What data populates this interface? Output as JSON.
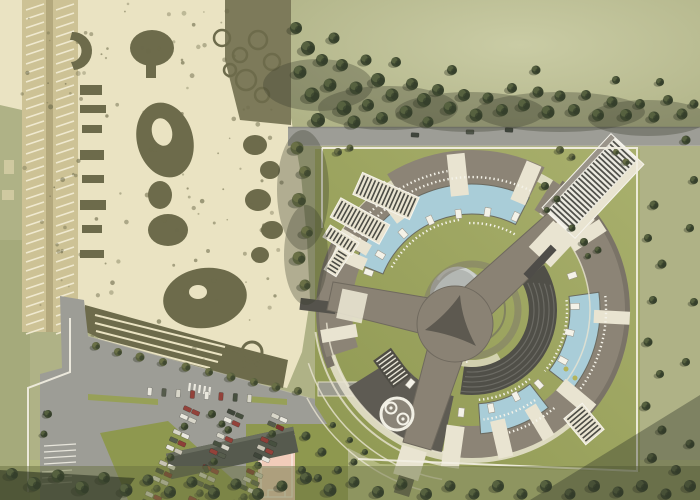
{
  "meta": {
    "view": "aerial-site-plan"
  },
  "palette": {
    "field": "#afb286",
    "fieldLight": "#c7c9a2",
    "fieldBottom": "#b4ba7e",
    "lawn": "#9ea762",
    "lawnDark": "#8e984f",
    "photoBg": "#eae3c2",
    "photoDark": "#6d6b4b",
    "photoDark2": "#7c7a57",
    "photoMid": "#a89f76",
    "photoRoad": "#cdc295",
    "road": "#9d9d96",
    "roadDark": "#8b8b84",
    "bldg": "#8c8476",
    "bldgDark": "#7a7367",
    "wing": "#5e5b53",
    "pool": "#a9cdd8",
    "cream": "#e9e4d1",
    "white": "#f4f2e8",
    "ybldg": "#8a8274",
    "innerDark": "#504f48",
    "treeDark": "#3e4830",
    "treeLight": "#5c6844",
    "treeOlive": "#59603e",
    "court": "#f1ccba",
    "carRed": "#8e3f38",
    "shadow": "rgba(52,57,40,0.38)"
  },
  "scene": {
    "complex": {
      "center": [
        472,
        310
      ],
      "arcs": [
        {
          "n": "outer-walk-1",
          "r1": 144,
          "r2": 153,
          "a0": -180,
          "a1": 0,
          "f": "cream",
          "o": 0.85
        },
        {
          "n": "outer-walk-2",
          "r1": 144,
          "r2": 153,
          "a0": 0,
          "a1": 180,
          "f": "cream",
          "o": 0.85
        },
        {
          "n": "topleft-bldg",
          "r1": 122,
          "r2": 152,
          "a0": -153,
          "a1": -126,
          "f": "bldg"
        },
        {
          "n": "top-roof",
          "r1": 114,
          "r2": 160,
          "a0": -122,
          "a1": -63,
          "f": "bldg"
        },
        {
          "n": "left-outer",
          "r1": 148,
          "r2": 156,
          "a0": 158,
          "a1": 210,
          "f": "bldgDark"
        },
        {
          "n": "left-bldg",
          "r1": 120,
          "r2": 153,
          "a0": 162,
          "a1": 205,
          "f": "bldg"
        },
        {
          "n": "right-outer",
          "r1": 150,
          "r2": 158,
          "a0": -55,
          "a1": 42,
          "f": "bldgDark"
        },
        {
          "n": "right-bldg",
          "r1": 118,
          "r2": 153,
          "a0": -58,
          "a1": 40,
          "f": "bldg"
        },
        {
          "n": "bottomright-bldg",
          "r1": 116,
          "r2": 148,
          "a0": 42,
          "a1": 96,
          "f": "bldg"
        },
        {
          "n": "bottomleft-wing",
          "r1": 88,
          "r2": 146,
          "a0": 102,
          "a1": 148,
          "f": "wing"
        },
        {
          "n": "pool-upperleft",
          "r1": 96,
          "r2": 126,
          "a0": -158,
          "a1": -63,
          "f": "pool",
          "s": "#6a6a60"
        },
        {
          "n": "pool-right",
          "r1": 98,
          "r2": 128,
          "a0": -8,
          "a1": 38,
          "f": "pool",
          "s": "#6a6a60"
        },
        {
          "n": "pool-bottom",
          "r1": 94,
          "r2": 124,
          "a0": 52,
          "a1": 86,
          "f": "pool",
          "s": "#6a6a60"
        },
        {
          "n": "amphitheater",
          "r1": 57,
          "r2": 85,
          "a0": -32,
          "a1": 98,
          "f": "innerDark"
        },
        {
          "n": "inner-walk",
          "r1": 50,
          "r2": 57,
          "a0": 60,
          "a1": 150,
          "f": "cream",
          "o": 0.7
        }
      ],
      "gaps": [
        [
          -150,
          136,
          34,
          12
        ],
        [
          -127,
          135,
          42,
          16
        ],
        [
          -96,
          136,
          42,
          18
        ],
        [
          -67,
          138,
          42,
          16
        ],
        [
          -33,
          137,
          38,
          14
        ],
        [
          3,
          140,
          36,
          13
        ],
        [
          40,
          136,
          40,
          15
        ],
        [
          59,
          131,
          36,
          13
        ],
        [
          77,
          132,
          38,
          15
        ],
        [
          98,
          138,
          42,
          18
        ],
        [
          170,
          135,
          36,
          13
        ],
        [
          203,
          133,
          34,
          13
        ]
      ],
      "kiosks": [
        [
          -160,
          110
        ],
        [
          -149,
          107
        ],
        [
          -132,
          103
        ],
        [
          -115,
          99
        ],
        [
          -98,
          97
        ],
        [
          -81,
          99
        ],
        [
          -65,
          103
        ],
        [
          -44,
          105
        ],
        [
          -19,
          106
        ],
        [
          -2,
          103
        ],
        [
          13,
          100
        ],
        [
          29,
          104
        ],
        [
          48,
          100
        ],
        [
          63,
          97
        ],
        [
          79,
          100
        ],
        [
          96,
          103
        ],
        [
          113,
          99
        ],
        [
          130,
          96
        ]
      ],
      "lounger_arcs": [
        [
          133,
          -155,
          -64
        ],
        [
          141,
          -150,
          -100
        ],
        [
          91,
          -152,
          -98
        ],
        [
          87,
          -92,
          -60
        ],
        [
          134,
          -6,
          36
        ],
        [
          95,
          -6,
          40
        ],
        [
          110,
          55,
          84
        ],
        [
          90,
          50,
          86
        ],
        [
          128,
          50,
          74
        ],
        [
          52,
          95,
          150
        ]
      ],
      "step_arcs": [
        [
          62,
          -26,
          95
        ],
        [
          67,
          -24,
          96
        ],
        [
          72,
          -22,
          97
        ],
        [
          77,
          -20,
          97
        ],
        [
          82,
          -18,
          98
        ]
      ],
      "path_arcs": [
        [
          158,
          96,
          172,
          2
        ],
        [
          172,
          100,
          162,
          1.5
        ],
        [
          187,
          104,
          152,
          1.5
        ],
        [
          146,
          98,
          175,
          1.6
        ],
        [
          118,
          -55,
          40,
          1.5
        ]
      ],
      "panels": [
        {
          "x": 386,
          "y": 196,
          "w": 62,
          "h": 24,
          "rot": 24,
          "style": "light"
        },
        {
          "x": 360,
          "y": 221,
          "w": 56,
          "h": 22,
          "rot": 29,
          "style": "light"
        },
        {
          "x": 341,
          "y": 240,
          "w": 34,
          "h": 14,
          "rot": 32,
          "style": "light"
        },
        {
          "x": 337,
          "y": 262,
          "w": 26,
          "h": 14,
          "rot": -58,
          "style": "light"
        },
        {
          "x": 392,
          "y": 368,
          "w": 34,
          "h": 22,
          "rot": 54,
          "style": "dark"
        },
        {
          "x": 584,
          "y": 424,
          "w": 34,
          "h": 24,
          "rot": 50,
          "style": "light"
        },
        {
          "x": 593,
          "y": 186,
          "w": 100,
          "h": 44,
          "rot": -47,
          "style": "building"
        }
      ],
      "palm_markers": [
        [
          566,
          369
        ],
        [
          575,
          378
        ]
      ]
    },
    "boundary": [
      [
        [
          322,
          148
        ],
        [
          637,
          148
        ],
        [
          637,
          471
        ],
        [
          358,
          459
        ]
      ],
      [
        [
          322,
          148
        ],
        [
          322,
          228
        ]
      ],
      [
        [
          70,
          318
        ],
        [
          70,
          372
        ],
        [
          28,
          388
        ],
        [
          28,
          492
        ]
      ]
    ],
    "parking": {
      "car_colors": [
        "#e9e7dd",
        "#93423a",
        "#47503f",
        "#d8d6c9",
        "#7e332e",
        "#e9e7dd",
        "#3f463a",
        "#c8c4b4",
        "#8e3f38",
        "#e9e7dd",
        "#565c4c",
        "#d8d6c9",
        "#93423a"
      ],
      "rows": [
        {
          "x": 150,
          "y": 504,
          "len": 102,
          "dir": -66,
          "n": 13,
          "double": true
        },
        {
          "x": 193,
          "y": 509,
          "len": 104,
          "dir": -66,
          "n": 13,
          "double": true
        },
        {
          "x": 237,
          "y": 513,
          "len": 104,
          "dir": -66,
          "n": 13,
          "double": true
        },
        {
          "x": 150,
          "y": 387,
          "len": 100,
          "dir": 4,
          "n": 8,
          "double": false
        }
      ],
      "road_cars": [
        [
          415,
          135,
          3,
          "#3f453c"
        ],
        [
          470,
          132,
          2,
          "#50564a"
        ],
        [
          509,
          130,
          4,
          "#3f453c"
        ],
        [
          206,
          469,
          70,
          "#454b3f"
        ],
        [
          213,
          489,
          70,
          "#3f453c"
        ],
        [
          47,
          414,
          20,
          "#50564a"
        ]
      ]
    },
    "band_shadows": [
      [
        318,
        85,
        55,
        26
      ],
      [
        388,
        108,
        70,
        22
      ],
      [
        470,
        112,
        75,
        20
      ],
      [
        560,
        112,
        85,
        20
      ],
      [
        648,
        118,
        60,
        18
      ],
      [
        303,
        190,
        26,
        60
      ],
      [
        306,
        255,
        22,
        50
      ]
    ],
    "trees": [
      [
        296,
        28,
        1.2,
        0
      ],
      [
        308,
        48,
        1.4,
        0
      ],
      [
        300,
        72,
        1.3,
        0
      ],
      [
        312,
        95,
        1.5,
        0
      ],
      [
        322,
        60,
        1.2,
        0
      ],
      [
        318,
        120,
        1.4,
        0
      ],
      [
        330,
        85,
        1.3,
        0
      ],
      [
        334,
        38,
        1.1,
        0
      ],
      [
        344,
        108,
        1.5,
        0
      ],
      [
        342,
        65,
        1.2,
        0
      ],
      [
        356,
        88,
        1.3,
        0
      ],
      [
        354,
        122,
        1.3,
        0
      ],
      [
        366,
        60,
        1.1,
        0
      ],
      [
        368,
        105,
        1.2,
        0
      ],
      [
        378,
        80,
        1.4,
        0
      ],
      [
        382,
        118,
        1.2,
        0
      ],
      [
        392,
        95,
        1.3,
        0
      ],
      [
        396,
        62,
        1.0,
        0
      ],
      [
        406,
        112,
        1.3,
        0
      ],
      [
        412,
        84,
        1.2,
        0
      ],
      [
        424,
        100,
        1.4,
        0
      ],
      [
        428,
        122,
        1.1,
        0
      ],
      [
        438,
        90,
        1.2,
        0
      ],
      [
        450,
        108,
        1.3,
        0
      ],
      [
        452,
        70,
        1.0,
        0
      ],
      [
        464,
        95,
        1.2,
        0
      ],
      [
        476,
        115,
        1.3,
        0
      ],
      [
        488,
        98,
        1.1,
        0
      ],
      [
        502,
        110,
        1.2,
        0
      ],
      [
        512,
        88,
        1.0,
        0
      ],
      [
        524,
        105,
        1.2,
        0
      ],
      [
        538,
        92,
        1.1,
        0
      ],
      [
        548,
        112,
        1.3,
        0
      ],
      [
        560,
        96,
        1.1,
        0
      ],
      [
        574,
        110,
        1.2,
        0
      ],
      [
        586,
        95,
        1.0,
        0
      ],
      [
        598,
        115,
        1.2,
        0
      ],
      [
        612,
        102,
        1.1,
        0
      ],
      [
        626,
        115,
        1.2,
        0
      ],
      [
        640,
        104,
        1.0,
        0
      ],
      [
        654,
        117,
        1.1,
        0
      ],
      [
        668,
        100,
        1.0,
        0
      ],
      [
        682,
        114,
        1.1,
        0
      ],
      [
        694,
        104,
        0.9,
        0
      ],
      [
        536,
        70,
        0.9,
        0
      ],
      [
        616,
        80,
        0.8,
        0
      ],
      [
        660,
        82,
        0.8,
        0
      ],
      [
        297,
        148,
        1.3,
        1
      ],
      [
        305,
        172,
        1.2,
        1
      ],
      [
        299,
        200,
        1.4,
        1
      ],
      [
        307,
        232,
        1.2,
        1
      ],
      [
        299,
        258,
        1.3,
        1
      ],
      [
        305,
        285,
        1.1,
        1
      ],
      [
        338,
        152,
        0.8,
        1
      ],
      [
        350,
        148,
        0.7,
        1
      ],
      [
        560,
        150,
        0.8,
        1
      ],
      [
        572,
        157,
        0.7,
        1
      ],
      [
        545,
        186,
        0.8,
        0
      ],
      [
        557,
        199,
        0.7,
        0
      ],
      [
        547,
        210,
        0.6,
        0
      ],
      [
        572,
        228,
        0.7,
        0
      ],
      [
        584,
        242,
        0.8,
        0
      ],
      [
        598,
        250,
        0.7,
        0
      ],
      [
        588,
        256,
        0.6,
        0
      ],
      [
        626,
        162,
        0.7,
        1
      ],
      [
        616,
        152,
        0.6,
        1
      ],
      [
        654,
        205,
        0.9,
        0
      ],
      [
        648,
        238,
        0.8,
        0
      ],
      [
        662,
        264,
        0.9,
        0
      ],
      [
        653,
        300,
        0.8,
        0
      ],
      [
        648,
        342,
        0.9,
        0
      ],
      [
        660,
        374,
        0.8,
        0
      ],
      [
        646,
        406,
        0.9,
        0
      ],
      [
        662,
        430,
        0.9,
        0
      ],
      [
        652,
        458,
        1.0,
        0
      ],
      [
        676,
        470,
        1.0,
        0
      ],
      [
        690,
        444,
        0.9,
        0
      ],
      [
        686,
        362,
        0.8,
        0
      ],
      [
        694,
        302,
        0.8,
        0
      ],
      [
        690,
        228,
        0.8,
        0
      ],
      [
        694,
        180,
        0.8,
        0
      ],
      [
        686,
        140,
        0.9,
        0
      ],
      [
        12,
        474,
        1.2,
        0
      ],
      [
        34,
        484,
        1.4,
        0
      ],
      [
        58,
        476,
        1.3,
        0
      ],
      [
        82,
        488,
        1.4,
        0
      ],
      [
        104,
        478,
        1.2,
        0
      ],
      [
        126,
        490,
        1.3,
        0
      ],
      [
        148,
        480,
        1.1,
        0
      ],
      [
        170,
        492,
        1.2,
        0
      ],
      [
        192,
        482,
        1.1,
        0
      ],
      [
        214,
        493,
        1.2,
        0
      ],
      [
        236,
        484,
        1.1,
        0
      ],
      [
        258,
        494,
        1.2,
        0
      ],
      [
        282,
        486,
        1.1,
        0
      ],
      [
        306,
        478,
        1.2,
        0
      ],
      [
        330,
        490,
        1.3,
        0
      ],
      [
        354,
        482,
        1.1,
        0
      ],
      [
        378,
        492,
        1.2,
        0
      ],
      [
        402,
        484,
        1.1,
        0
      ],
      [
        426,
        494,
        1.2,
        0
      ],
      [
        450,
        486,
        1.1,
        0
      ],
      [
        474,
        494,
        1.1,
        0
      ],
      [
        498,
        486,
        1.2,
        0
      ],
      [
        522,
        494,
        1.1,
        0
      ],
      [
        546,
        486,
        1.2,
        0
      ],
      [
        570,
        494,
        1.1,
        0
      ],
      [
        594,
        486,
        1.2,
        0
      ],
      [
        618,
        492,
        1.1,
        0
      ],
      [
        642,
        486,
        1.2,
        0
      ],
      [
        666,
        494,
        1.1,
        0
      ],
      [
        690,
        486,
        1.2,
        0
      ],
      [
        96,
        346,
        0.8,
        1
      ],
      [
        118,
        352,
        0.8,
        1
      ],
      [
        140,
        357,
        0.9,
        1
      ],
      [
        163,
        362,
        0.8,
        1
      ],
      [
        186,
        367,
        0.9,
        1
      ],
      [
        209,
        372,
        0.8,
        1
      ],
      [
        231,
        377,
        0.9,
        1
      ],
      [
        254,
        382,
        0.8,
        1
      ],
      [
        276,
        387,
        0.9,
        1
      ],
      [
        298,
        391,
        0.8,
        1
      ],
      [
        306,
        436,
        0.9,
        0
      ],
      [
        322,
        452,
        0.9,
        0
      ],
      [
        302,
        470,
        0.8,
        0
      ],
      [
        338,
        470,
        0.8,
        0
      ],
      [
        318,
        478,
        0.8,
        0
      ],
      [
        212,
        414,
        0.8,
        0
      ],
      [
        222,
        424,
        0.7,
        0
      ],
      [
        48,
        414,
        0.8,
        0
      ],
      [
        44,
        434,
        0.7,
        0
      ],
      [
        354,
        462,
        0.7,
        0
      ],
      [
        350,
        440,
        0.6,
        0
      ],
      [
        365,
        452,
        0.6,
        0
      ],
      [
        333,
        425,
        0.6,
        0
      ]
    ]
  }
}
